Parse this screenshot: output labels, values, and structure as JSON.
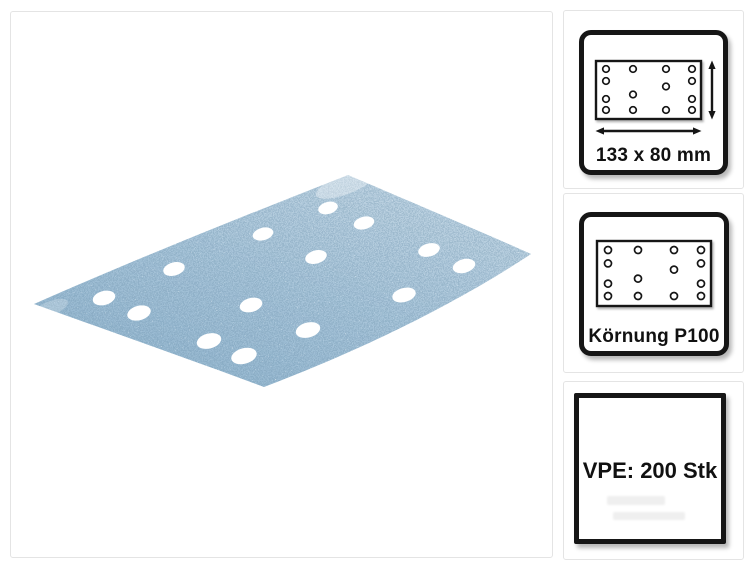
{
  "product_image": {
    "description": "Blue abrasive sanding strip shown in perspective with 14 dust extraction holes",
    "sheet_base_color": "#a6c3d8",
    "sheet_light_color": "#c0d4e2",
    "sheet_dark_color": "#92b5ce",
    "hole_color": "#ffffff",
    "hole_count": 14
  },
  "info_badges": [
    {
      "id": "dimensions",
      "label": "133 x 80 mm",
      "diagram": "sheet-with-dimension-arrows"
    },
    {
      "id": "grit",
      "label": "Körnung P100",
      "diagram": "sheet-with-holes"
    },
    {
      "id": "pack",
      "label": "VPE: 200 Stk",
      "diagram": "none"
    }
  ],
  "colors": {
    "badge_border": "#161616",
    "card_border": "#e4e4e4",
    "text": "#111111"
  }
}
